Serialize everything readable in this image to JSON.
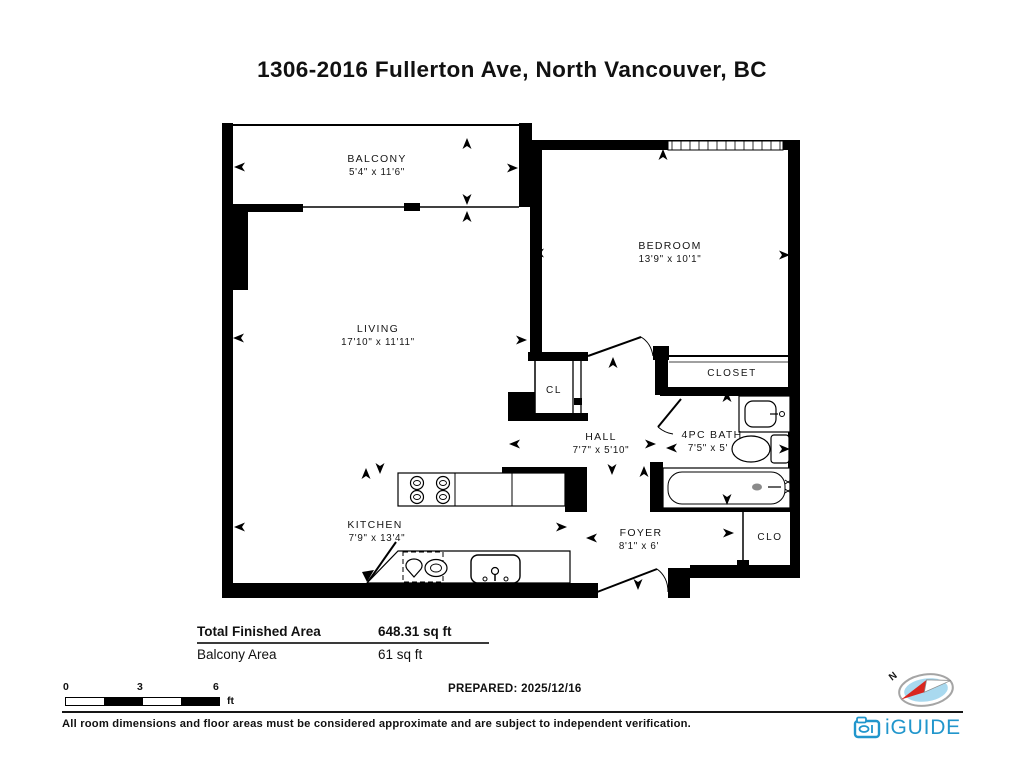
{
  "title": "1306-2016 Fullerton Ave, North Vancouver, BC",
  "rooms": {
    "balcony": {
      "name": "BALCONY",
      "dims": "5'4\" x 11'6\""
    },
    "living": {
      "name": "LIVING",
      "dims": "17'10\" x 11'11\""
    },
    "bedroom": {
      "name": "BEDROOM",
      "dims": "13'9\" x 10'1\""
    },
    "cl": {
      "name": "CL"
    },
    "closet": {
      "name": "CLOSET"
    },
    "hall": {
      "name": "HALL",
      "dims": "7'7\" x 5'10\""
    },
    "bath": {
      "name": "4PC BATH",
      "dims": "7'5\" x 5'"
    },
    "kitchen": {
      "name": "KITCHEN",
      "dims": "7'9\" x 13'4\""
    },
    "foyer": {
      "name": "FOYER",
      "dims": "8'1\" x 6'"
    },
    "clo": {
      "name": "CLO"
    }
  },
  "area_table": {
    "rows": [
      {
        "label": "Total Finished Area",
        "value": "648.31 sq ft"
      },
      {
        "label": "Balcony Area",
        "value": "61 sq ft"
      }
    ]
  },
  "scale_bar": {
    "ticks": [
      "0",
      "3",
      "6"
    ],
    "unit": "ft"
  },
  "prepared": "PREPARED: 2025/12/16",
  "compass": {
    "north_label": "N"
  },
  "disclaimer": "All room dimensions and floor areas must be considered approximate and are subject to independent verification.",
  "brand": {
    "name": "iGUIDE"
  },
  "colors": {
    "wall": "#000000",
    "brand_blue": "#2196cc",
    "compass_red": "#d9261f",
    "compass_fill": "#a9d9ef"
  }
}
